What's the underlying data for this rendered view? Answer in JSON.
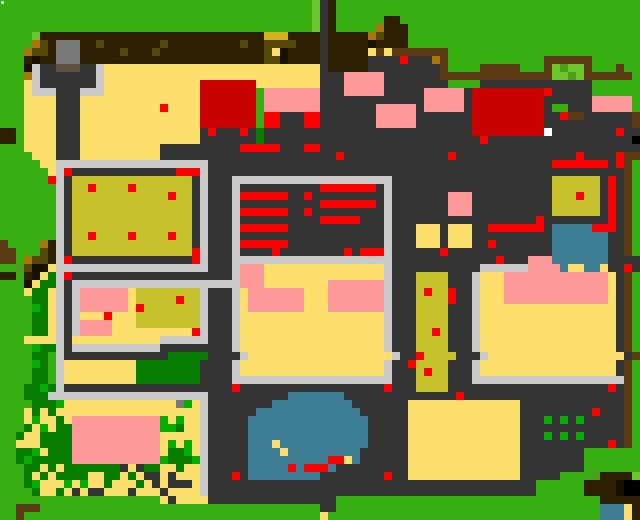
{
  "app": {
    "view": "overworld-map",
    "type": "pixel-tile-map"
  },
  "map": {
    "width": 640,
    "height": 520,
    "cell_size": 8,
    "cols": 80,
    "rows_count": 65,
    "palette": {
      "G": "#37AE11",
      "g": "#6CC72E",
      "q": "#4F9E1B",
      "N": "#077D00",
      "n": "#05AE05",
      "B": "#2E2002",
      "K": "#171102",
      "F": "#5C3A14",
      "A": "#A8780F",
      "U": "#D2B01E",
      "o": "#554708",
      "O": "#C6C12B",
      "D": "#333333",
      "C": "#C9C9C9",
      "Y": "#FDDF6D",
      "P": "#FF9898",
      "R": "#FF0000",
      "E": "#C80000",
      "T": "#3E7E95",
      "M": "#7A7A7A",
      "m": "#5F4F3E",
      "W": "#FFFFFF"
    },
    "palette_names": {
      "G": "grass",
      "g": "light-leaves",
      "q": "olive-leaves",
      "N": "dark-tree",
      "n": "bright-crop",
      "B": "dark-soil",
      "K": "deep-shadow",
      "F": "wood-path",
      "A": "gold-dirt",
      "U": "mustard-roof",
      "o": "dark-olive-patch",
      "O": "crop-field",
      "D": "dark-floor",
      "C": "concrete",
      "Y": "sand",
      "P": "pink-roof",
      "R": "red-marker",
      "E": "dark-red-roof",
      "T": "water",
      "M": "stone-statue",
      "m": "statue-base",
      "W": "white-marker"
    },
    "rows": [
      "GGGGGGGGGGGGGGGGGGGGGGGGGGGGGGGGGGGGGGGgDBGGGGGGGGGGGGGGGGGGGGGGGGGGGGGGGGGGGGGG",
      "GGGGGGGGGGGGGGGGGGGGGGGGGGGGGGGGGGGGGGGgDBGGGGGGGGGGGGGGGGGGGGGGGGGGGGGGGGGGGGGG",
      "GGGGGGGGGGGGGGGGGGGGGGGGGGGGGGGGGGGGGGGgDBGGGGGGBBGGGGGGGGGGGGGGGGGGGGGGGGGGGGGG",
      "GGGGGGGGGGGGGGGGGGGGGGGGGGGGGGGGGGGGGGGgDBGGGGGABBBGGGGGGGGGGGGGGGGGGGGGGGGGGGGG",
      "GGGGgBBBBBBBBBBBBBBBBBBBBBBBBBBBBUUUBBBBDBBBBBAoBBBGGGGGGGGGGGGGGGGGGGGGGGGGGGGG",
      "GGGGAoBMMMBBoBBBBBBBoBBBBBBBBBoBBooooBBBDBBBBBKBBBBGGGGGGGGGGGGGGGGGGGGGGGGGGGGG",
      "GGGAooBMMMBBBBBoBBBoBBBBBBBBBBBBBoYKBBBBDBBBBBYFYFFFFFFFGGGGGGGGGGGGGGGGGGGGGGGG",
      "GGGBKBBMMMBBBBBBBBBBBBBBBBBBBBBBBooKBBBBDBBBBBDDDDRDDDAFGGGGGGGGGGGGFFFFFFGGGGGG",
      "GGGKCDDmmmDDCYYYYYYYYYYYYYYYYYYYYYYYYYYYDBBBBBDDDDDDDDDFGGGGFFFFFGGGFgqggFGGGFGG",
      "GGGACDDDDDDDCYYYYYYYYYYYYYYYYYYYYYYYYYYYDDDPPPPPDDDDDDDFFFFFFFFFFFFFFggqgFFFFFFG",
      "GGGYCDDDDDDDCYYYYYYYYYYYYEEEEEEEYYYYYYYYDDDPPPPPDDDDDDDDGGGGDDDDDDDDDDDDDDGGGGGG",
      "GGGYCCCDDDCCCYYYYYYYYYYYYEEEEEEEGPPPPPPPDDDPPPPPDDDDDPPPPPDEEEEEEEEERDDDDDGGGGGG",
      "GGGYYYYDDDYYYYYYYYYYYYYYYEEEEEEEGPPPPPPPDDDDDDDDDDDDDPPPPPDEEEEEEEEEDDDDDDPPPPPG",
      "GGGYYYYDDDYYYYYYYYYYRYYYYEEEEEEEGPPPPPPPDDDDDDDPPPPPDPPPPPDEEEEEEEEEDGGDDDPPPPPG",
      "GGGYYYYDDDYYYYYYYYYYYYYYYEEEEEEEGRRDDDRRDDDDDDDPPPPPDDDDDDDEEEEEEEEEDDRFFDDDDDDF",
      "GGGYYYYDDDYYYYYYYYYYYYYYYEEEEEEEGRRDDDRRDDDDDDDPPPPPDDDDDDDEEEEEEEEEDDDDDDDDDDDF",
      "BBGYYYYDDDYYYYYYYYYYYYYYYDRDDDRDNDDDDDDDDDDDDDDDDDDDDDDDDDDEEEEEEEEEWDDDDDDDDRDD",
      "BBGYYYYDDDYYYYYYYYYYYYYYYDDDDDDDNDDDDDDDDDDDDDDDDDDDDDDDDDDDRDDDDDDDDDDDDDDDDDD",
      "GGGYYYYDDDYYYYYYYYYYDDDDDDDDDDRRRRRDDDRRDDDDDDDDDDDDDDDDDDDDDDDDDDDDDDDDDDDDDDDD",
      "GGGGYYYDDDYYYYYYYYYYDDDDDDDDDDDDDDDDDDDDDDRDDDDDDDDDDDDDRDDDDDDDDDDDDDDDRDDDDRFF",
      "GGGGGYYCCCCCCCCCCCCCCCCCCCDDDDDDDDDDDDDDDDDDDDDDDDDDDDDDDDDDDDDDDDDDDRRRRRRRDRFG",
      "GGGGGGYCRDDDDDDDDDDDDDRRRCDDDDDDDDDDDDDDDDDDDDDDDDDDDDDDDDDDDDDDDDDDDDDDDDDDDDFG",
      "GGGGGGRCDOOOOOOOOOOOOOOODCDDDCCCCCCCCCCCCCCCCCCCCDDDDDDDDDDDDDDDDDDDDOOOOOODRDFG",
      "GGGGGGGCDOOROOOOROOOOOOODCDDDCDDDDDDDDDDRRRRRRRDCDDDDDDDDDDDDDDDDDDDDOOOOOODRDFG",
      "GGGGGGGCDOOOOOOOOOOOOROODCDDDCRRRRRRDDRDDDDDDDDDCDDDDDDDPPPDDDDDDDDDDOOOROODRDFG",
      "GGGGGGGCDOOOOOOOOOOOOOOODCDDDCDDDDDDDDDDRRRRRRRDCDDDDDDDPPPDDDDDDDDDDOOOOOODRDFG",
      "GGGGGGGCDOOOOOOOOOOOOOOODCDDDCRRRRRRDDRDDDDDDDDDCDDDDDDDPPPDDDDDDDDDDOOOOOODRDFG",
      "GGGGGGGCDOOOOOOOOOOOOOOODCDDDCDDDDDDDDDDRRRRRDDDCDDDDDDDDDDDDDDDDDDRDDDDDDDDRDFG",
      "GGGGGGGCDOOOOOOOOOOOOOOODCDDDCRRRRRRDDDDDDDDDDDDCDDDYYYDYYYDDRRRRRRRDTTTTTRRRDFG",
      "GGGGGGGCDOOROOOOROOOOROODCDDDCDDDDDDDDDDDDDDDDDDCDDDYYYDYYYDDDDDDDDDDTTTTTTTDDFG",
      "FGGGGABCDOOOOOOOOOOOOOOODCDDDCRRRRRRDDDDDDDDDDDDCDDDYYYDYYYDDRDDDDDDDTTTTTTTDDFG",
      "FFGGGoBCDOOOOOOOOOOOOOOORCDDDCDDDDRDDDDDDDDRDRRRCDDDDDDRDDDDDDDDDDDDDTTTTTTTDDFG",
      "FFGAooBCRDDDDDDDDDDDDDDDRCDDDCCCCCCCCCCCCCCCCCCCCDDDDDDDDDDDDDRDDDPPPTTTTTTTDDDD",
      "GGqoKKYCCCCCCCCCCCCCCCCCCCDDDCPPPYYYYYYYYYYYYYYYCDDDDDDDDDDDCCCCCCPPPPTYYTTYDDRD",
      "BBGBKYNCRDDDDDDDDDDDDDDDDDDDDCPPPYYYYYYYYYYYYYYYCDDDOOOODDDCYYYPPPPPPPPPPPPPYDFG",
      "GGGKYNNCDCCCCCCCCCCCCCCCCCCCCCPPPYYYYYYYYPPPPPPPCDDDOOOODDDCYYYPPPPPPPPPPPPPYDFG",
      "GGGYNNYCDCPPPPPPYOOOOOOOOCDDDCYPPPPPPPYYYPPPPPPPCDDDOROORDDCYYYPPPPPPPPPPPPPYDFG",
      "GGGGNNYCDCPPPPPPYOOOOOROOCDDDCYPPPPPPPYYYPPPPPPPCDDDOOOORDDCYYYPPPPPPPPPPPPPYDFG",
      "GGGGnNYCDCPPPPPPYROOOOOOOCDDDCYPPPPPPPYYYPPPPPPPCDDDOOOODDDCYYYYYYYYYYYYYYYYYDFG",
      "GGGGNNYCDCYYYRYYYOOOOOOOOCDDDCYYYYYYYYYYYYYYYYYYCDDDOOOODDDCYYYYYYYYYYYYYYYYYDFG",
      "GGGGNNYCDCPPPPYYYOOOOOOOOCDDDCYYYYYYYYYYYYYYYYYYCDDDOOOODDDCYYYYYYYYYYYYYYYYYDFG",
      "GGGGNNYCDCPPPPYYYYYYYYYYRCDDDCYYYYYYYYYYYYYYYYYYCDDDOORODDDCYYYYYYYYYYYYYYYYYDFG",
      "GGGYYYYCDYYYYYYYYYYYCCCCCCDDDCYYYYYYYYYYYYYYYYYYCDDDOOOODDDCYYYYYYYYYYYYYYYYYDFG",
      "GGGGnNNCDCCCCCCCCCCCDDDDDDDDDCYYYYYYYYYYYYYYYYYYCDDDOOOODDDCYYYYYYYYYYYYYYYYYDFG",
      "GGGGNNGCDDDDDDDDDDDDDNNNNNDDDDCYYYYYYYYYYYYYYYYYYCDDROOOODDDCYYYYYYYYYYYYYYYYYDFG",
      "GGGGnNGCYYYYYYYYYNNNNNNNNDDDDCYYYYYYYYYYYYYYYYYYCDDROOOODDDCYYYYYYYYYYYYYYYYYDFG",
      "GGGGNNGCYYYYYYYYYNNNNNNNNDDDDCYYYYYYYYYYYYYYYYYYCDDDOROODDDCYYYYYYYYYYYYYYYYYDFG",
      "GGGGNNGCYYYYYYYYYNNNNNNNNDDDDCCCCCCCCCCCCCCCCCCCCDDDOOOODDDCCCCCCCCCCCCCCCCCCCFG",
      "GGGNNnNCDDDDDDDDDDDDDDDDDDDDDRDDDDDDDDDDDDDDDDDDRDDDOOOODDDDDDDDDDDDDDDDDDDDRDFG",
      "GGGNNNCCCCCCCCCCCCCCCCCCCCDDDDDDDDDDTTTTTTTDDDDDDDDDDDDDDRDDDDDDDDDDDDDDDDDDDDFG",
      "GGGGNNNnYYYYYYYYYYYYYYMnYCDDDDDDDDTTTTTTTTTTDDDDDDDYYYYYYYYYYYYYYDDDDDDDDDDDDDFG",
      "GGGYNYNYYYYYYYYYYYYYYYYYYCDDDDDDTTTTTTTTTTTTTDDDDDDYYYYYYYYYYYYYYDDDDDDDDDRDDDFG",
      "GGGYnYYNYPPPPPPPPPPPnYnYYCDDDDDTTTTTTTTTTTTTTTDDDDDYYYYYYYYYYYYYYDDDnDnDnDDDDDFG",
      "GGGNYnYNNPPPPPPPPPPPnnNYYCDDDDDTTTTTTTTTTTTTTTDDDDDYYYYYYYYYYYYYYDDDDDDDDDDDDDFG",
      "GGNYYNNNNPPPPPPPPPPPYYYYYCDDDDDTTTTTTTTTTTTTTTDDDDDYYYYYYYYYYYYYYDDDnDnDnDDDDDFG",
      "GGYYYNNNNPPPPPPPPPPPYnYnYCDDDDDTTTYTTTTTTTTTTTDDDDDYYYYYYYYYYYYYYDDDDDDDDDDDRDFG",
      "GGNNnYNNNPPPPPPPPPPPYNNnYCDDDDDTTTTYTTTTTTTTTDDDDDDYYYYYYYYYYYYYYDDDDDDDDGGGGGGG",
      "GGNnNNNNNPPPPPPPPPPPnNNNnCDDDDDTTTTTTTTTTRRYTDDDDDDYYYYYYYYYYYYYYDDDDDDDDGGGGGGG",
      "GGGNNYNYNNNNNNNDYDNNYYNYYCDDDDDTTTTTRTRRRTDDDDDDDDDYYYYYYYYYYYYYYDDDDDDDDGGGGGGG",
      "GGGNYNYNNNNYYNNYNYDDYDYYYCDDDRDTTTTTTTTTDDDDDDDDRDDYYYYYYYYYYYYYYDDDDDGGGGqBBBBg",
      "GGGNnYYYnYnYYNYYYNYDYDDDYCDDDDDDDDDDDDDDDDDDDDDDDDDDDDDDDDDDDDDDDDDGGGGGGBBBBK",
      "GGGGNYYNYDYDDYYYDYYYDYYYYCDDDDDDDDDDDDDDDDDDDDDDDDDDDDDDDDDDDDDDDDDGGGGGGBBBBK",
      "GGGGGGGGGGGGGGGGGGGGYDYYYYDDDDDDDDDDDDDDDDGGGGGGGGGGGGGGGGGGGGGGGGGGGGGGGGGBBBBB",
      "GGFFFGGGGGGGGGGGGGGGGGGGGGGGGGGGGGGGGGGGDDGGGGGGGGGGGGGGGGGGGGGGGGGGGGGGGGGTTTYB",
      "GGFGGGGGGGGGGGGGGGGGGGGGGGGGGGGGGGGGGGGGYGGGGGGGGGGGGGGGGGGGGGGGGGGGGGGGGGGTTTYB"
    ],
    "artifacts": [
      {
        "x": 1,
        "y": 1,
        "w": 3,
        "h": 3,
        "color": "#FFFFFF",
        "name": "cursor-dot"
      }
    ]
  }
}
